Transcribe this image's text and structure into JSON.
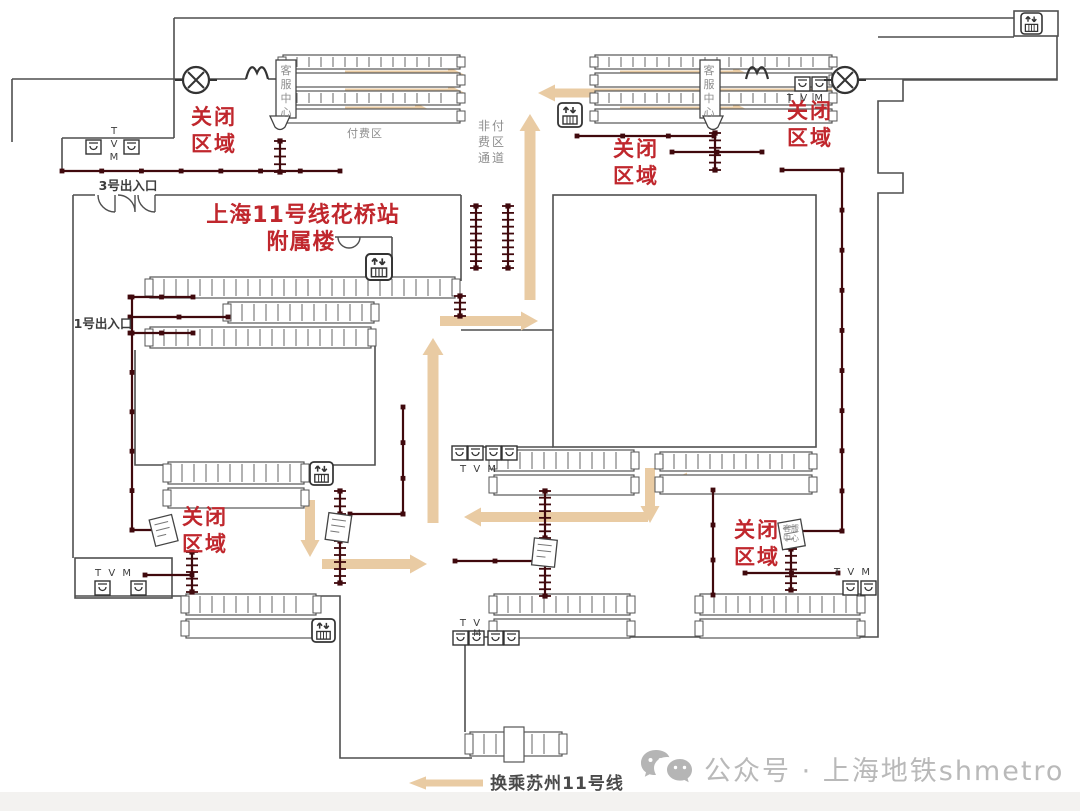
{
  "page": {
    "background": "#ffffff",
    "watermark": {
      "icon": "wechat-icon",
      "text": "公众号 · 上海地铁shmetro"
    }
  },
  "diagram": {
    "title_line1": "上海11号线花桥站",
    "title_line2": "附属楼",
    "labels": {
      "closed_area": "关闭区域",
      "non_paid_passage": "非付费区通道",
      "paid_area": "付费区",
      "customer_service_center": "客服中心",
      "tvm": "T V M",
      "tvm_short": "T V",
      "tvm_m": "M",
      "exit_3": "3号出入口",
      "exit_1": "1号出入口",
      "transfer": "换乘苏州11号线"
    },
    "colors": {
      "wall": "#4f4f4f",
      "barrier": "#40090d",
      "arrow": "#e9cba3",
      "closed_red": "#c0272d",
      "gray_text": "#8e8e8e",
      "dark_text": "#3d3d3d",
      "watermark": "#b9b9b9"
    },
    "icons": [
      "elevator-icon",
      "tvm-icon",
      "closed-crossing-icon",
      "double-door-icon",
      "entrance-door-icon",
      "security-check-icon",
      "service-booth-icon",
      "fare-gate-icon"
    ]
  }
}
